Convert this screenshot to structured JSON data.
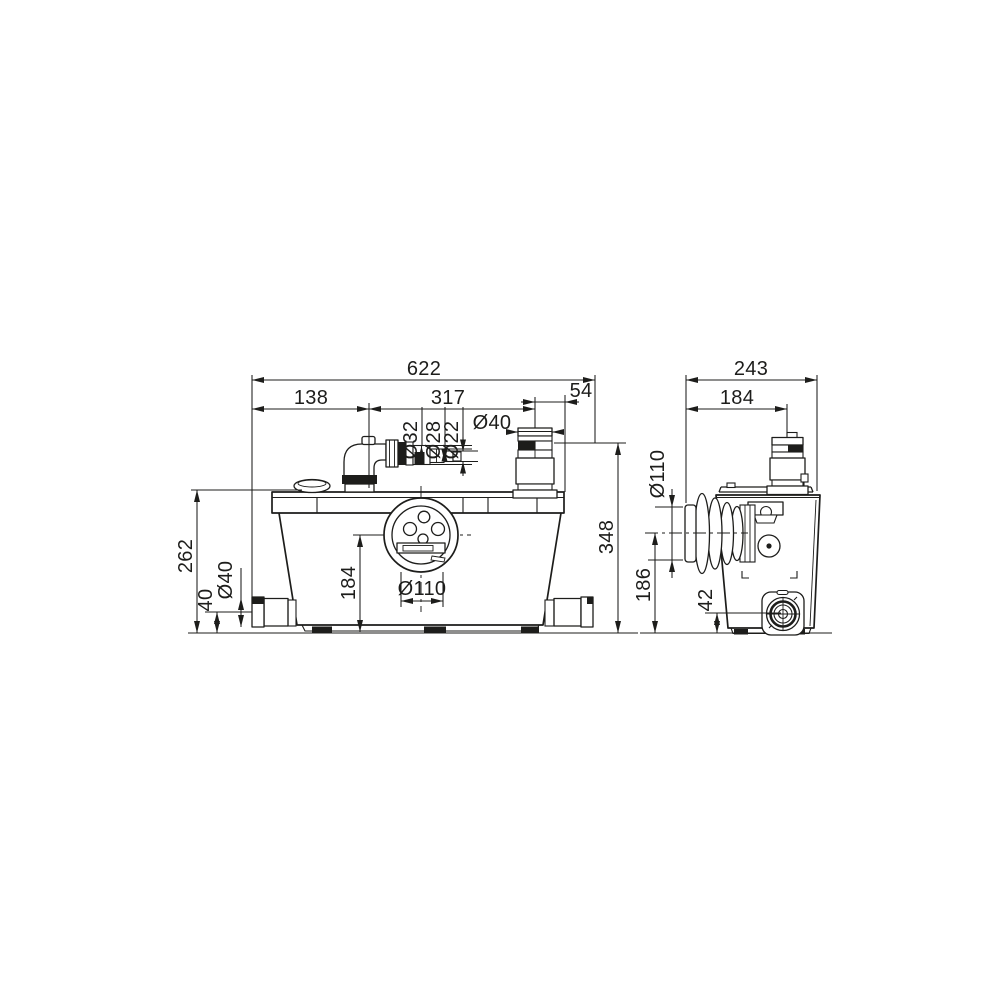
{
  "drawing": {
    "front_view": {
      "dims": {
        "total_width": "622",
        "inlet_elbow_offset": "138",
        "elbow_to_outlet": "317",
        "outlet_to_edge": "54",
        "adapter_dia_1": "Ø32",
        "adapter_dia_2": "Ø28",
        "adapter_dia_3": "Ø22",
        "outlet_dia": "Ø40",
        "body_height": "262",
        "side_inlet_height": "40",
        "side_inlet_dia": "Ø40",
        "inlet_center_height": "184",
        "inlet_dia": "Ø110",
        "total_height": "348"
      }
    },
    "side_view": {
      "dims": {
        "total_depth": "243",
        "outlet_center_offset": "184",
        "rear_inlet_dia": "Ø110",
        "rear_inlet_center_height": "186",
        "side_outlet_center_height": "42"
      }
    }
  }
}
